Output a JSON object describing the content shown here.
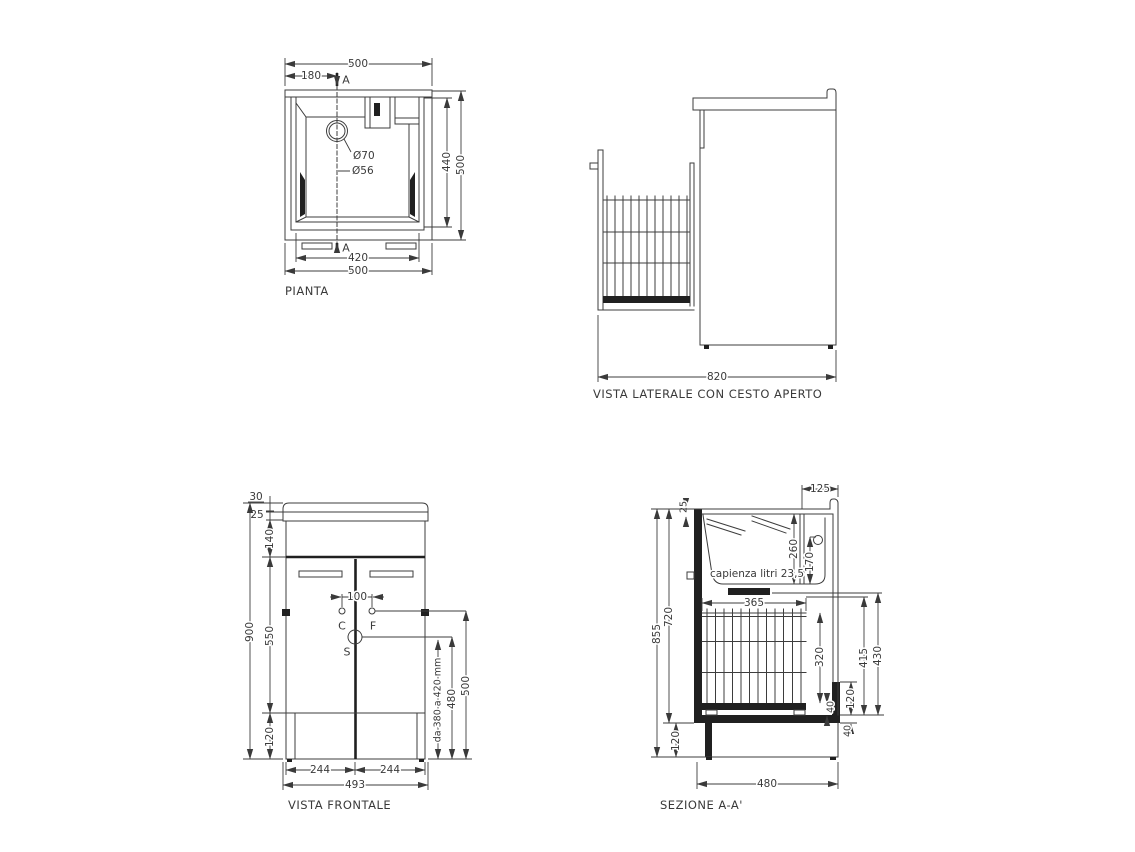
{
  "colors": {
    "ink": "#3a3a3a",
    "fill_black": "#202020",
    "background": "#ffffff"
  },
  "views": {
    "pianta": {
      "title": "PIANTA",
      "dims": {
        "overall_width_top": "500",
        "drain_offset": "180",
        "section_top": "A",
        "section_bottom": "A",
        "hole_outer": "Ø70",
        "hole_inner": "Ø56",
        "inner_depth": "440",
        "overall_depth": "500",
        "inner_width": "420",
        "overall_width_bottom": "500"
      }
    },
    "laterale": {
      "title": "VISTA LATERALE CON CESTO APERTO",
      "dims": {
        "open_depth": "820"
      }
    },
    "frontale": {
      "title": "VISTA FRONTALE",
      "dims": {
        "top_edge": "30",
        "top_band": "25",
        "apron": "140",
        "overall_height": "900",
        "door_zone": "550",
        "plinth": "120",
        "holes_spacing": "100",
        "point_c": "C",
        "point_f": "F",
        "point_s": "S",
        "drain_range": "da 380 a 420 mm",
        "h480": "480",
        "h500": "500",
        "door_left": "244",
        "door_right": "244",
        "overall_width": "493"
      }
    },
    "sezione": {
      "title": "SEZIONE A-A'",
      "dims": {
        "ledge": "125",
        "top_thickness": "25",
        "basin_depth": "260",
        "overflow_height": "170",
        "capacity": "capienza litri 23,5",
        "basket_width": "365",
        "basket_height": "320",
        "overall_height": "855",
        "carcass_height": "720",
        "h415": "415",
        "h430": "430",
        "bracket": "120",
        "wheel": "40",
        "bottom_panel": "40",
        "plinth": "120",
        "overall_depth": "480"
      }
    }
  }
}
